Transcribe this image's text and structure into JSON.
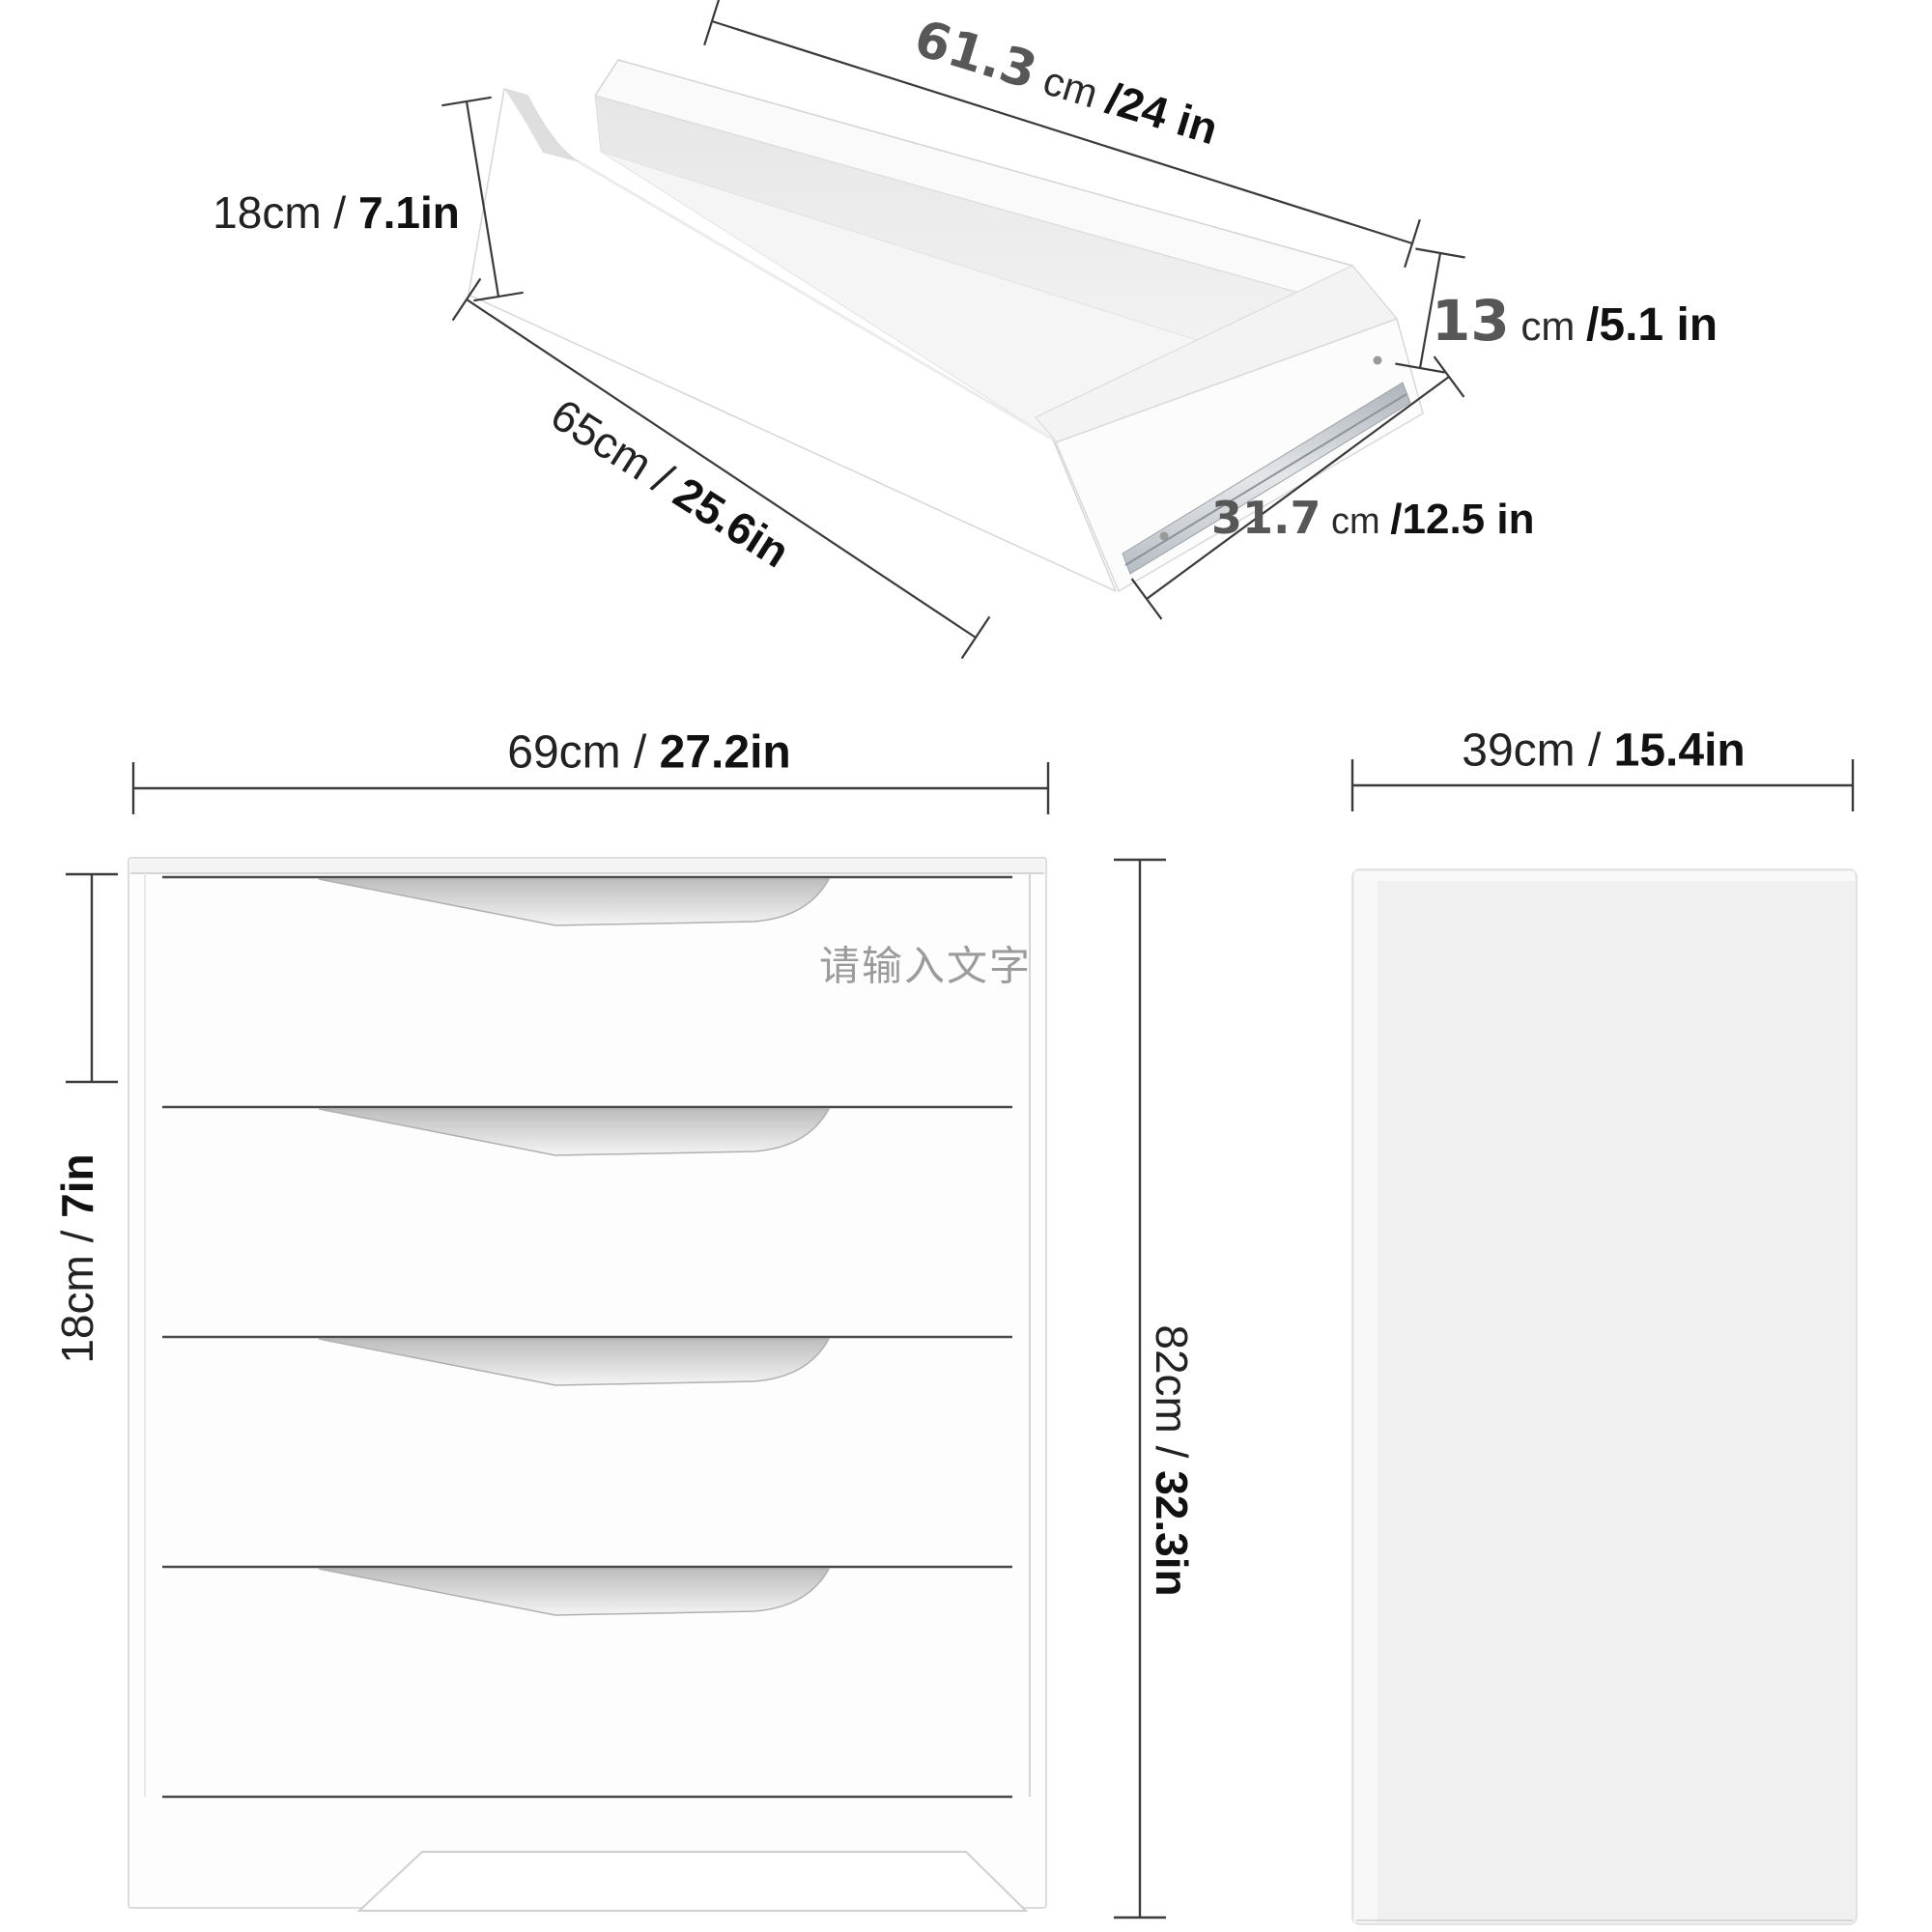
{
  "watermark": "请输入文字",
  "drawer_view": {
    "width_cm": "61.3",
    "width_mid": " cm ",
    "width_in": "/24 in",
    "front_height": "18cm / ",
    "front_height_bold": "7.1in",
    "side_height_cm": "13",
    "side_height_mid": " cm ",
    "side_height_in": "/5.1 in",
    "bottom_width": "65cm / ",
    "bottom_width_bold": "25.6in",
    "depth_cm": "31.7",
    "depth_mid": " cm ",
    "depth_in": "/12.5 in"
  },
  "front_view": {
    "width": "69cm / ",
    "width_bold": "27.2in",
    "drawer_height": "18cm / ",
    "drawer_height_bold": "7in",
    "height": "82cm / ",
    "height_bold": "32.3in"
  },
  "side_view": {
    "depth": "39cm / ",
    "depth_bold": "15.4in"
  }
}
